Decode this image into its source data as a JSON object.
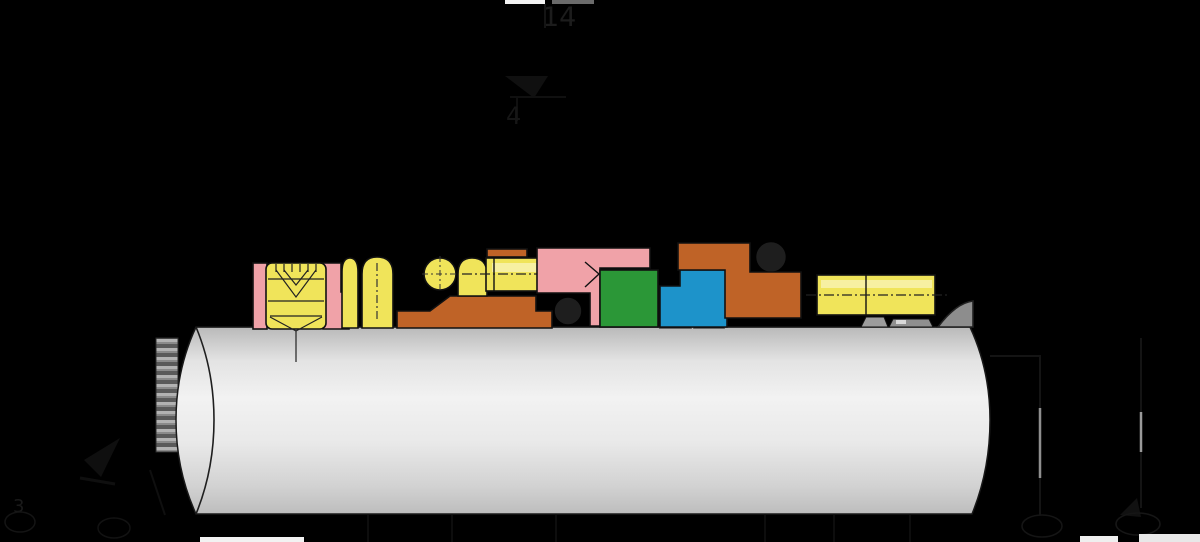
{
  "scene": {
    "description": "Cross-section engineering diagram of a cartridge mechanical seal assembly mounted on a shaft",
    "background": "#000000"
  },
  "palette": {
    "pink": "#f0a2a8",
    "yellow": "#f0e45a",
    "yellow_light": "#f7f0a2",
    "orange": "#bf6327",
    "green": "#2b9737",
    "blue": "#1d93ca",
    "dark_ring": "#1e1e1e",
    "gray_wedge": "#8d8d8d",
    "gray_sleeve": "#c9c9c9",
    "gray_bump": "#9c9c9c",
    "outline": "#111111",
    "faint_ink": "#161616",
    "white_strip": "#f2f2f2",
    "gray_strip": "#6b6b6b"
  },
  "callouts": {
    "top": "14",
    "upper": "4",
    "bottom_left": "3",
    "bottom_left_2": "",
    "bottom_right_1": "",
    "bottom_right_2": ""
  }
}
